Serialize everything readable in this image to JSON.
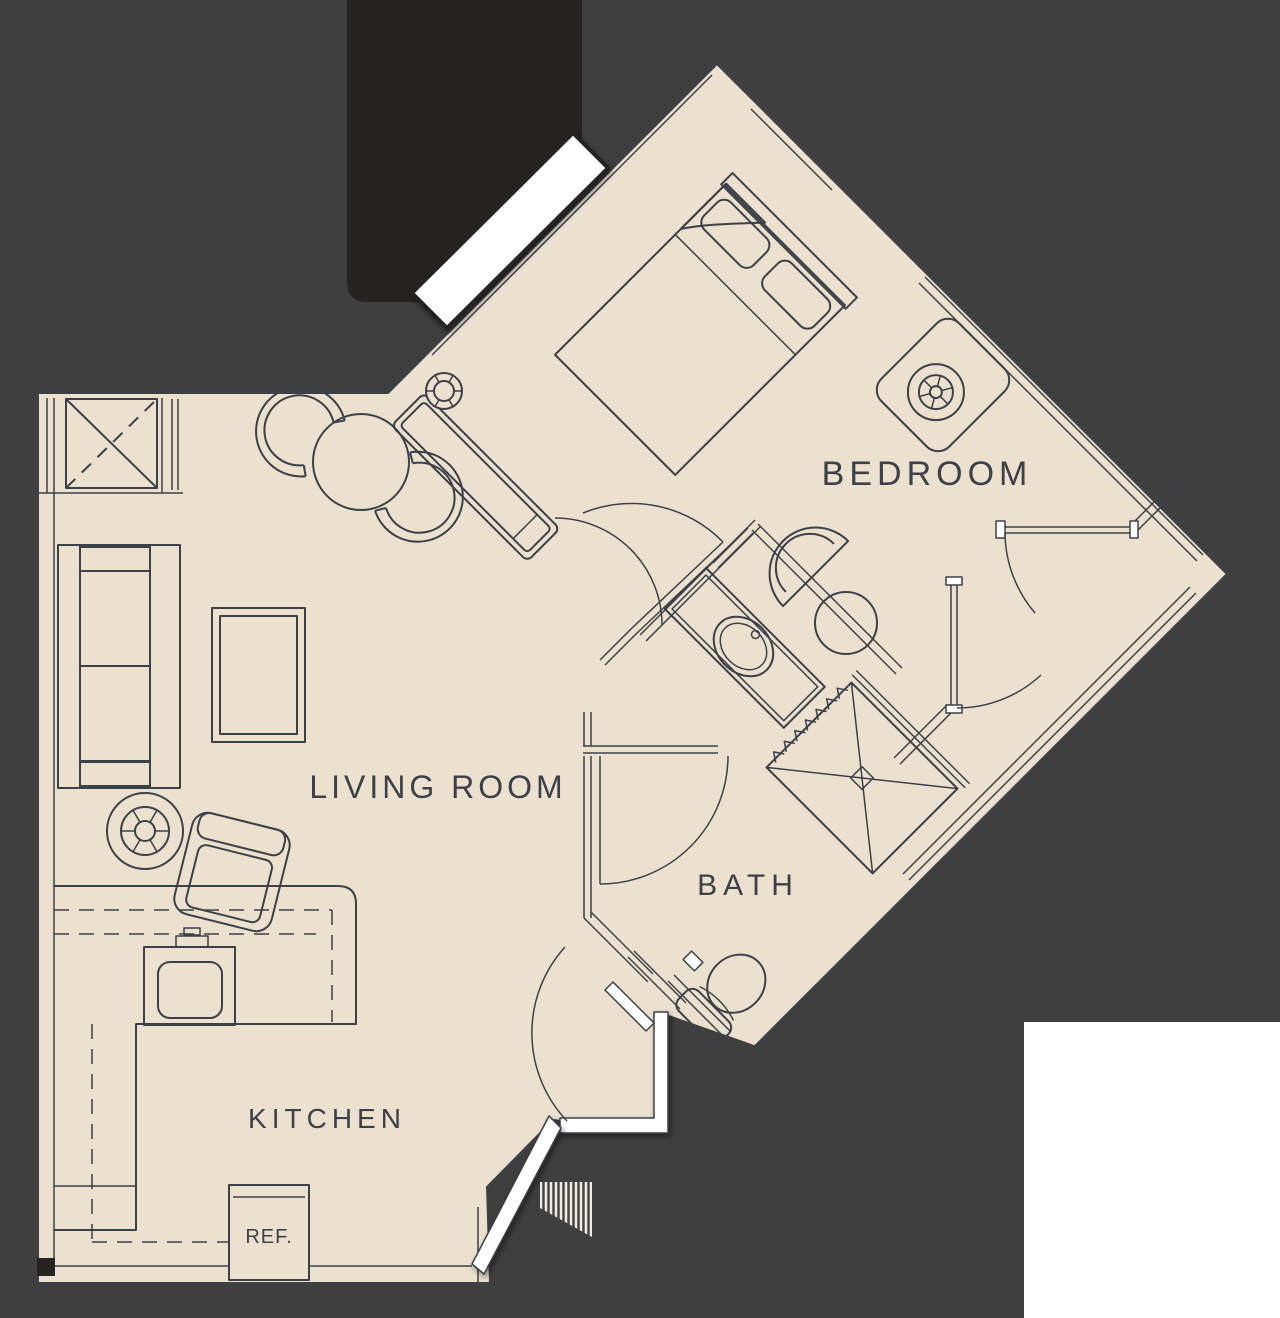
{
  "colors": {
    "background": "#3f3f3f",
    "building_mass": "#272323",
    "floor": "#ece1cf",
    "line": "#3b4049",
    "wall_white": "#ffffff",
    "label": "#3b4049"
  },
  "rooms": {
    "bedroom": {
      "label": "BEDROOM"
    },
    "living_room": {
      "label": "LIVING ROOM"
    },
    "bath": {
      "label": "BATH"
    },
    "kitchen": {
      "label": "KITCHEN"
    }
  },
  "appliances": {
    "refrigerator": {
      "label": "REF."
    }
  }
}
